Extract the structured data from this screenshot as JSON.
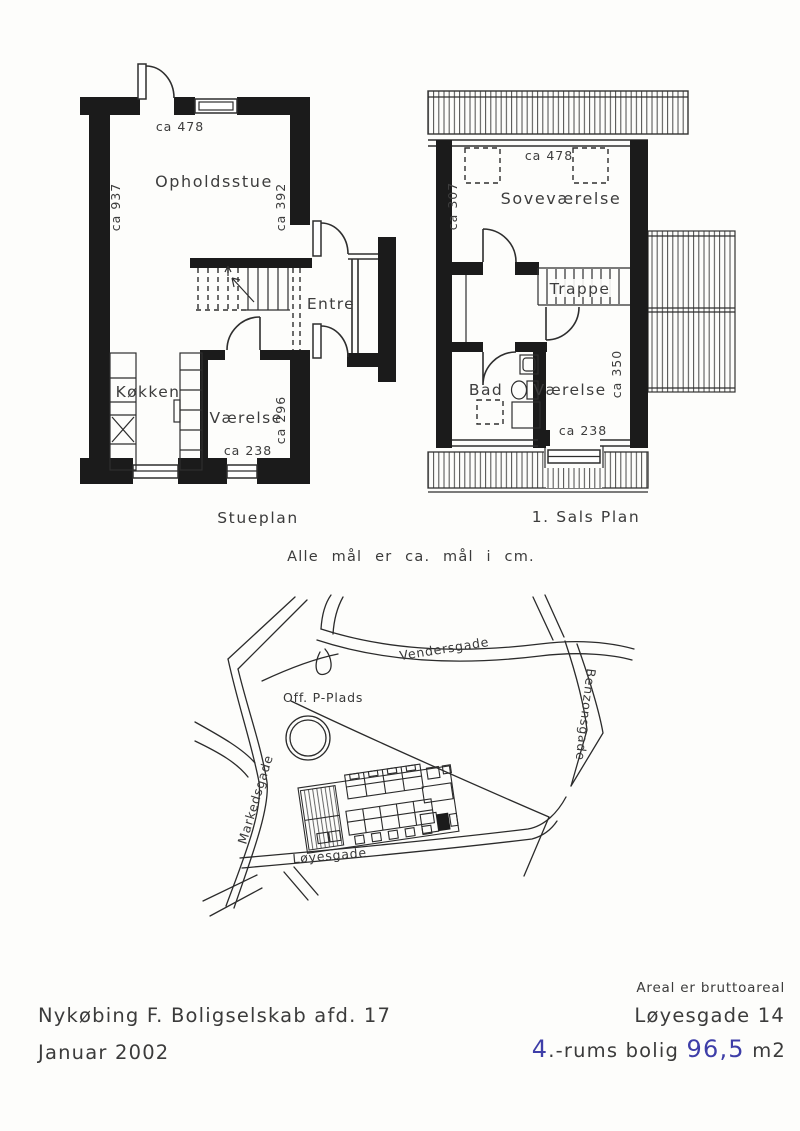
{
  "captions": {
    "stueplan": "Stueplan",
    "salsplan": "1. Sals Plan",
    "note": "Alle mål er ca. mål i cm."
  },
  "stueplan": {
    "rooms": {
      "opholdsstue": "Opholdsstue",
      "entre": "Entre",
      "kokken": "Køkken",
      "varelse": "Værelse"
    },
    "dims": {
      "top": "ca 478",
      "left": "ca 937",
      "right": "ca 392",
      "room_right": "ca 296",
      "room_bottom": "ca 238"
    }
  },
  "salsplan": {
    "rooms": {
      "sovevarelse": "Soveværelse",
      "trappe": "Trappe",
      "bad": "Bad",
      "varelse": "Værelse"
    },
    "dims": {
      "top": "ca 478",
      "left": "ca 307",
      "right": "ca 350",
      "room_bottom": "ca 238"
    }
  },
  "map": {
    "streets": {
      "vendersgade": "Vendersgade",
      "benzonsgade": "Benzonsgade",
      "markedsgade": "Markedsgade",
      "loyesgade": "Løyesgade"
    },
    "labels": {
      "parking": "Off. P-Plads"
    }
  },
  "footer": {
    "area_note": "Areal er bruttoareal",
    "company": "Nykøbing F. Boligselskab afd. 17",
    "date": "Januar 2002",
    "address": "Løyesgade 14",
    "rooms_value": "4",
    "rooms_suffix": ".-rums bolig",
    "area_value": "96,5",
    "area_unit": "m2"
  },
  "colors": {
    "ink": "#2e2e2e",
    "wall": "#1b1b1b",
    "handwriting_blue": "#3e3ea8",
    "paper": "#fdfdfb"
  }
}
